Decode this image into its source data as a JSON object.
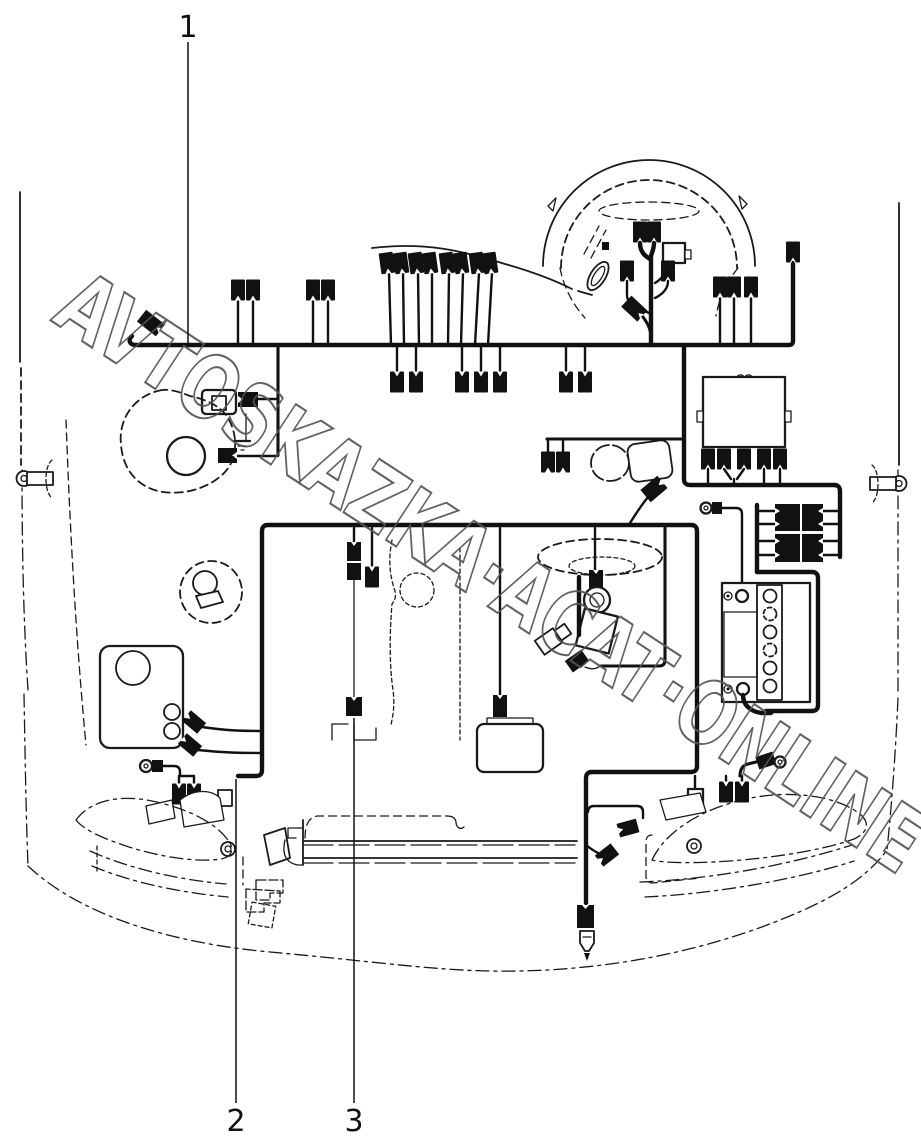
{
  "diagram": {
    "kind": "vehicle-wiring-harness-parts-diagram",
    "background_color": "#ffffff",
    "line_color": "#1a1a1a",
    "callouts": [
      {
        "label": "1",
        "position": "top"
      },
      {
        "label": "2",
        "position": "bottom-left"
      },
      {
        "label": "3",
        "position": "bottom-center"
      }
    ],
    "watermark": {
      "text": "AVTOSKAZKA·ACAT·ONLINE",
      "color": "#555555",
      "angle_deg": 33
    },
    "components": [
      "main-harness",
      "steering-wheel",
      "steering-column-connectors",
      "blower-assembly",
      "blower-resistor",
      "ground-point",
      "fuel-filler",
      "engine-harness",
      "engine-block",
      "fuel-tank-sender",
      "washer-reservoir",
      "relay-box",
      "connector-bank",
      "battery",
      "horn-assembly",
      "radiator",
      "left-headlamp",
      "right-headlamp",
      "fog-lamp-bulb",
      "left-side-marker",
      "right-side-marker"
    ]
  }
}
